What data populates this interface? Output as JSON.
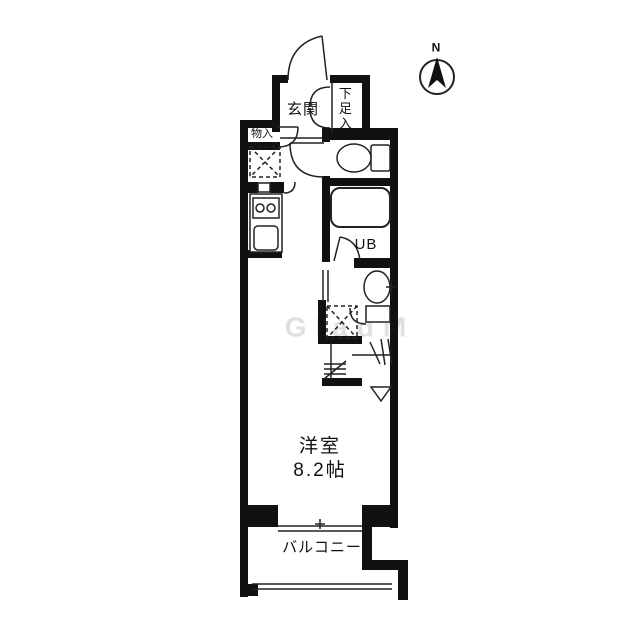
{
  "document": {
    "type": "apartment-floor-plan",
    "watermark": "GladM"
  },
  "rooms": {
    "genkan": "玄関",
    "shoe_storage": "下足入",
    "storage": "物入",
    "unit_bath": "UB",
    "main_room_name": "洋室",
    "main_room_size": "8.2帖",
    "balcony": "バルコニー"
  },
  "compass": {
    "north_label": "N"
  },
  "colors": {
    "wall": "#111111",
    "line": "#222222",
    "background": "#ffffff",
    "watermark": "#c7c7c7"
  },
  "fixtures": [
    "entrance-door",
    "storage-door",
    "shoe-cabinet-double-doors",
    "toilet",
    "bathtub",
    "unit-bath-door",
    "washbasin",
    "washing-machine-space",
    "refrigerator-space",
    "kitchen-stove",
    "kitchen-sink",
    "folding-partition-marks",
    "room-entry-marker",
    "balcony-sliding-window",
    "balcony-railing",
    "north-compass"
  ]
}
